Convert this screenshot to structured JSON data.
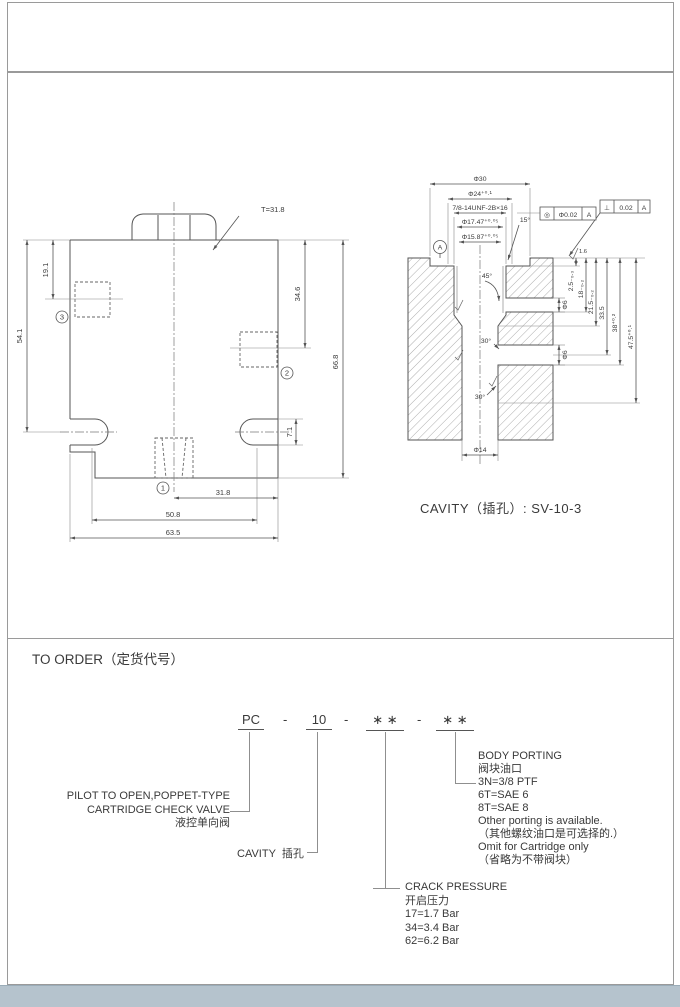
{
  "drawing_left": {
    "torque_note": "T=31.8",
    "dim_19_1": "19.1",
    "dim_54_1": "54.1",
    "dim_34_6": "34.6",
    "dim_66_8": "66.8",
    "dim_7_1": "7.1",
    "dim_31_8": "31.8",
    "dim_50_8": "50.8",
    "dim_63_5": "63.5",
    "port_1": "1",
    "port_2": "2",
    "port_3": "3"
  },
  "drawing_cavity": {
    "dia_30": "Φ30",
    "dia_24": "Φ24⁺⁰·¹",
    "thread": "7/8-14UNF-2B×16",
    "dia_17_47": "Φ17.47⁺⁰·⁰⁵",
    "dia_15_87": "Φ15.87⁺⁰·⁰⁵",
    "ang_15": "15°",
    "ang_45": "45°",
    "ang_30a": "30°",
    "ang_30b": "30°",
    "dia_6a": "Φ6",
    "dia_6b": "Φ6",
    "dia_14": "Φ14",
    "dep_2_5": "2.5₋₀.₃",
    "dep_18": "18₋₀.₂",
    "dep_21_5": "21.5₋₀.₂",
    "dep_33_5": "33.5",
    "dep_38": "38⁺⁰·²",
    "dep_47_5": "47.5⁺⁰·¹",
    "rough": "1.6",
    "gdt_conc_sym": "◎",
    "gdt_conc_tol": "Φ0.02",
    "gdt_conc_datum": "A",
    "gdt_perp_sym": "⊥",
    "gdt_perp_tol": "0.02",
    "gdt_perp_datum": "A",
    "datum": "A",
    "caption": "CAVITY（插孔）: SV-10-3"
  },
  "order": {
    "heading": "TO ORDER（定货代号）",
    "code": {
      "s1": "PC",
      "sep1": "-",
      "s2": "10",
      "sep2": "-",
      "s3": "∗ ∗",
      "sep3": "-",
      "s4": "∗ ∗"
    },
    "valve_label": {
      "l1": "PILOT TO OPEN,POPPET-TYPE",
      "l2": "CARTRIDGE CHECK VALVE",
      "l3": "液控单向阀"
    },
    "cavity_label": "CAVITY  插孔",
    "crack": {
      "l1": "CRACK PRESSURE",
      "l2": "开启压力",
      "l3": "17=1.7 Bar",
      "l4": "34=3.4 Bar",
      "l5": "62=6.2 Bar"
    },
    "porting": {
      "l1": "BODY PORTING",
      "l2": "阀块油口",
      "l3": "3N=3/8  PTF",
      "l4": "6T=SAE  6",
      "l5": "8T=SAE  8",
      "l6": "Other porting is available.",
      "l7": "（其他螺纹油口是可选择的.）",
      "l8": "Omit for Cartridge only",
      "l9": "（省略为不带阀块）"
    }
  }
}
